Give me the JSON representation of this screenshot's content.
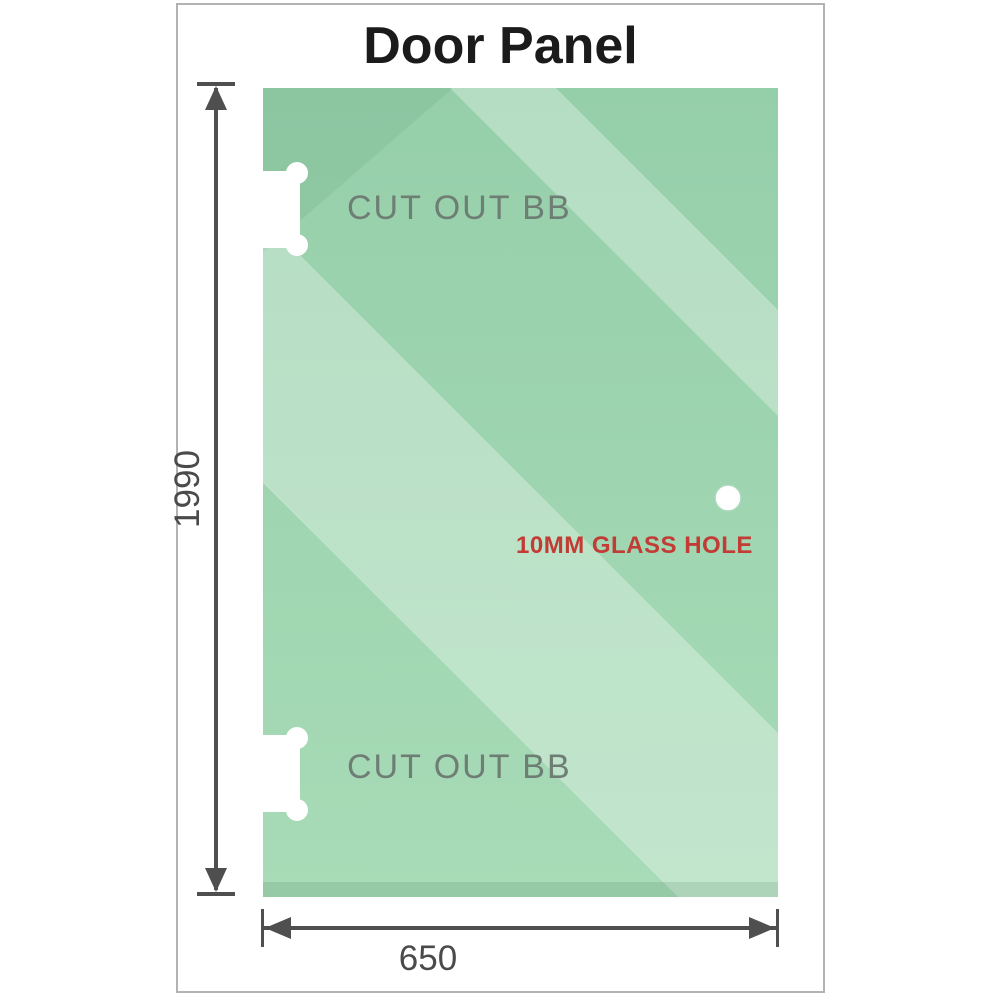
{
  "title": "Door Panel",
  "panel": {
    "cutout_top_label": "CUT OUT BB",
    "cutout_bottom_label": "CUT OUT BB",
    "hole_label": "10MM GLASS HOLE"
  },
  "dimensions": {
    "height": "1990",
    "width": "650"
  },
  "colors": {
    "glass_green_top": "#95cfaa",
    "glass_green_bottom": "#a8dbb7",
    "glass_highlight": "#c7e7d1",
    "cutout_label_gray": "#6e7e74",
    "dimension_gray": "#4a4a4a",
    "hole_label_red": "#c23b34",
    "title_color": "#1b1b1b",
    "frame_border_gray": "#b3b3b3"
  }
}
